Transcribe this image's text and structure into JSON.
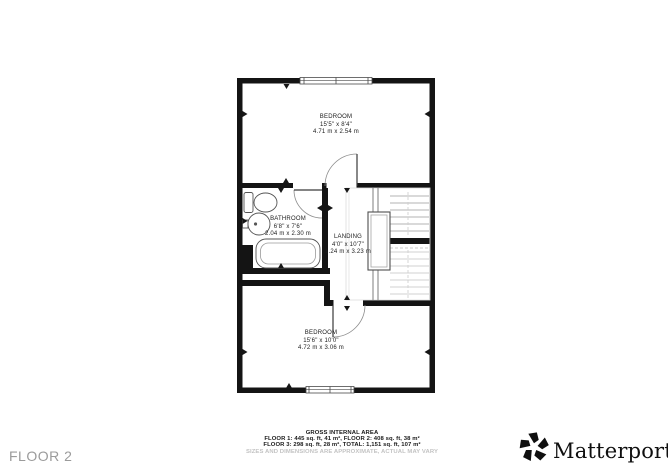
{
  "floor_label": "FLOOR 2",
  "rooms": [
    {
      "id": "bedroom-1",
      "name": "BEDROOM",
      "dims_imperial": "15'5\" x 8'4\"",
      "dims_metric": "4.71 m x 2.54 m"
    },
    {
      "id": "bathroom",
      "name": "BATHROOM",
      "dims_imperial": "6'8\" x 7'6\"",
      "dims_metric": "2.04 m x 2.30 m",
      "fixtures": [
        "toilet-icon",
        "sink-icon",
        "bathtub-icon"
      ]
    },
    {
      "id": "landing",
      "name": "LANDING",
      "dims_imperial": "4'0\" x 10'7\"",
      "dims_metric": "1.24 m x 3.23 m",
      "fixtures": [
        "staircase-icon"
      ]
    },
    {
      "id": "bedroom-2",
      "name": "BEDROOM",
      "dims_imperial": "15'6\" x 10'0\"",
      "dims_metric": "4.72 m x 3.06 m"
    }
  ],
  "footer": {
    "area_title": "GROSS INTERNAL AREA",
    "area_line1": "FLOOR 1: 445 sq. ft, 41 m², FLOOR 2: 408 sq. ft, 38 m²",
    "area_line2": "FLOOR 3: 298 sq. ft, 28 m², TOTAL: 1,151 sq. ft, 107 m²",
    "disclaimer": "SIZES AND DIMENSIONS ARE APPROXIMATE, ACTUAL MAY VARY",
    "brand": "Matterport",
    "brand_mark": "®"
  },
  "colors": {
    "wall": "#141414",
    "fixture_line": "#555555",
    "stair_line": "#9a9a9a",
    "label_text": "#1c1c1c",
    "muted_text": "#c3c3c3",
    "floor_label_text": "#9b9b9b",
    "brand_text": "#0f0f0f"
  }
}
